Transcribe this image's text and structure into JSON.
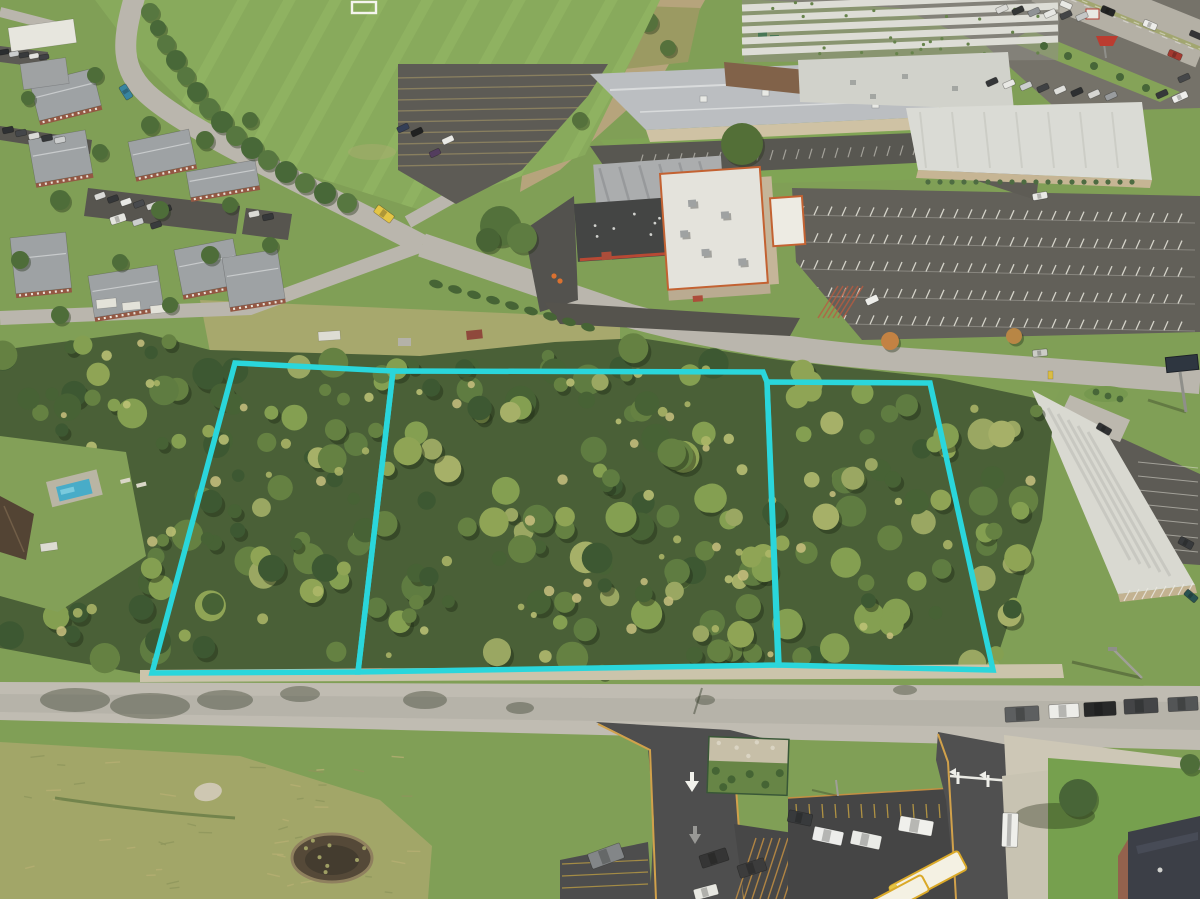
{
  "image": {
    "kind": "aerial-drone-photograph",
    "subject": "Oblique overhead drone photo of three adjacent wooded vacant land parcels outlined in cyan, bounded by a residential street on the south and suburban commercial development (big-box stores, restaurant, recreation center, apartment complex, sports field, highway) on the north",
    "parcel_count": 3,
    "season": "late-summer",
    "lighting": "bright-sunlight"
  },
  "overlay": {
    "outline_color": "#1fd4dc",
    "outline_width": 5.5,
    "parcels": [
      {
        "id": "parcel-1",
        "points": "235,363 393,371 358,672 152,673"
      },
      {
        "id": "parcel-2",
        "points": "393,371 763,372 767,382 778,665 358,672"
      },
      {
        "id": "parcel-3",
        "points": "767,382 930,383 993,670 779,665"
      }
    ]
  },
  "palette": {
    "grass_base": "#7a9a50",
    "field_green": "#82a656",
    "field_stripe": "#93b862",
    "lawn_green": "#74994a",
    "scrub_olive": "#9da263",
    "canopy_dark": "#3e5a2d",
    "canopy_mid": "#5d7b3a",
    "canopy_light": "#8aa04f",
    "canopy_olive": "#a2ac62",
    "canopy_highlight": "#bcc172",
    "road_light": "#bdb9b0",
    "road_top": "#b7b3ab",
    "asphalt_dark": "#454547",
    "asphalt_mid": "#55534f",
    "concrete": "#cbc5b5",
    "gravel": "#c9c1a9",
    "dirt_tan": "#b3a078",
    "roof_white": "#dedfdb",
    "roof_gray": "#b8bbc0",
    "roof_dark": "#3a3b3d",
    "roof_navy": "#323540",
    "brick_red": "#8f4f3c",
    "trim_orange": "#c05a2a",
    "wall_tan": "#c6b697",
    "pond_brown": "#4c4030",
    "pool_blue": "#3fa8c8",
    "bus_yellow": "#e3c23e",
    "curb_yellow": "#cf9c44",
    "stripe_yellow": "#c9b36a",
    "sign_red": "#b83228",
    "hatch_orange": "#c08a3c"
  },
  "vehicles": {
    "parked_along_south_road": 5,
    "school_buses": 2,
    "highway_cars": 5,
    "note": "numerous small cars scattered in commercial and apartment parking lots"
  },
  "scene_features": [
    "sports-field",
    "soccer-goal",
    "apartment-complex",
    "curving-street",
    "recreation-center",
    "restaurant-building",
    "big-box-stores",
    "warehouse-rows",
    "highway",
    "large-striped-parking-lot",
    "strip-mall",
    "billboard",
    "wooded-parcels",
    "residential-pool",
    "backyard-clearing",
    "boundary-road",
    "entrance-driveways",
    "fenced-landscape-bed",
    "hatched-parking-lot",
    "school-parking-lot",
    "school-buses",
    "school-building",
    "pond",
    "scrub-meadow"
  ]
}
